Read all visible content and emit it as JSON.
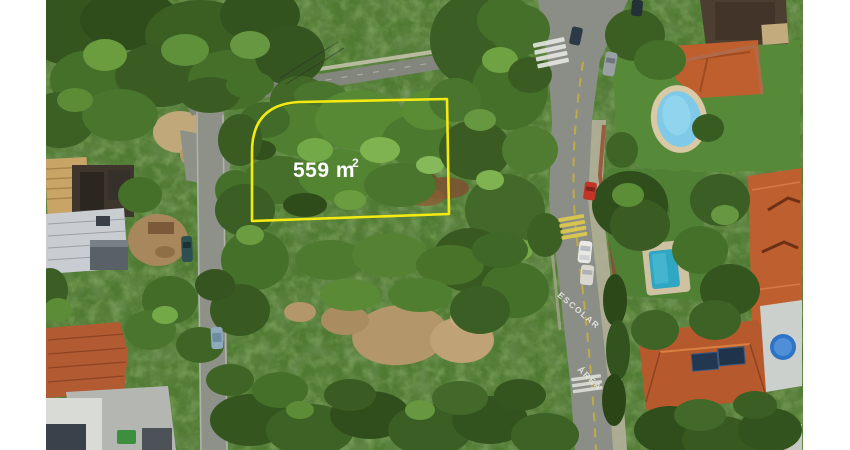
{
  "photo": {
    "description_name": "aerial-lot-photo",
    "background": "#ffffff"
  },
  "lot": {
    "area_value": "559 m",
    "area_exponent": "2",
    "outline_color": "#f4ea12",
    "label_color": "#ffffff"
  },
  "road_markings": {
    "school_zone_text": "ESCOLAR",
    "area_text": "ÁREA",
    "marking_color": "#e9e9e2"
  },
  "palette": {
    "canopy_base": "#4f7a31",
    "road_gray": "#8a8e86",
    "dirt_tan": "#b3976a",
    "terracotta_roof": "#b85c30",
    "pool_water": "#7ecae8",
    "lawn_green": "#568a38"
  }
}
